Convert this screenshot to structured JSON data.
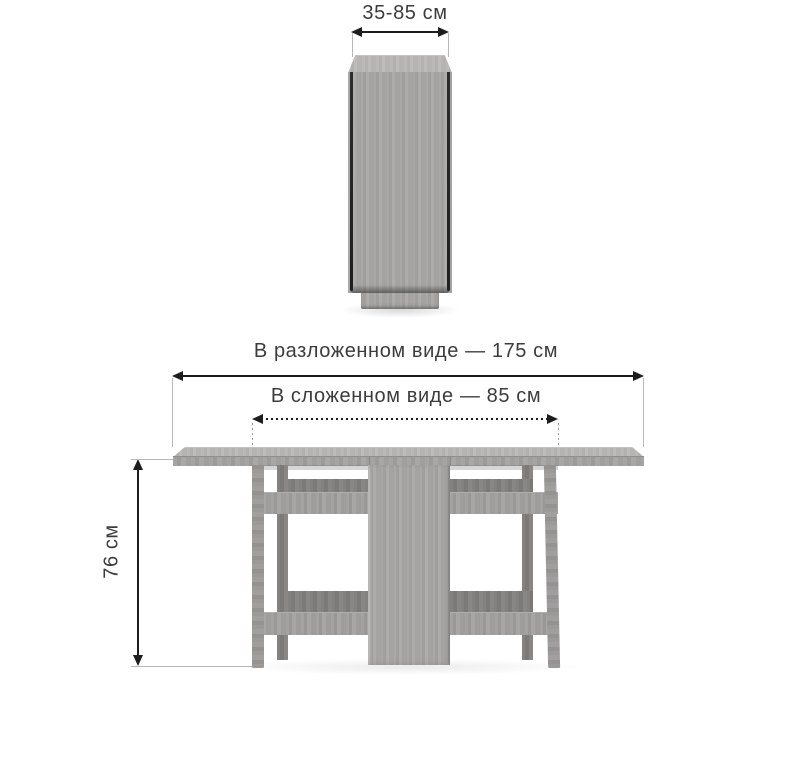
{
  "diagram": {
    "title": "folding-table-dimensions",
    "views": {
      "folded_side_view": {
        "description": "table folded, seen from the end"
      },
      "unfolded_front_view": {
        "description": "table unfolded, front view"
      }
    },
    "dimensions": {
      "depth_range": {
        "label": "35-85 см",
        "style": "solid-arrow"
      },
      "unfolded_width": {
        "label": "В разложенном виде — 175 см",
        "style": "solid-arrow"
      },
      "folded_width": {
        "label": "В сложенном виде — 85 см",
        "style": "dotted-arrow"
      },
      "height": {
        "label": "76 см",
        "style": "solid-arrow-vertical"
      }
    },
    "colors": {
      "background": "#ffffff",
      "wood_top_surface": "#b5b4b2",
      "wood_face": "#a4a3a2",
      "wood_shadowed": "#7e7d7c",
      "leaf_edge_dark": "#262626",
      "dimension_line": "#1d1d1d",
      "extension_line": "#b8b8b8",
      "text": "#3c3c3c"
    }
  }
}
